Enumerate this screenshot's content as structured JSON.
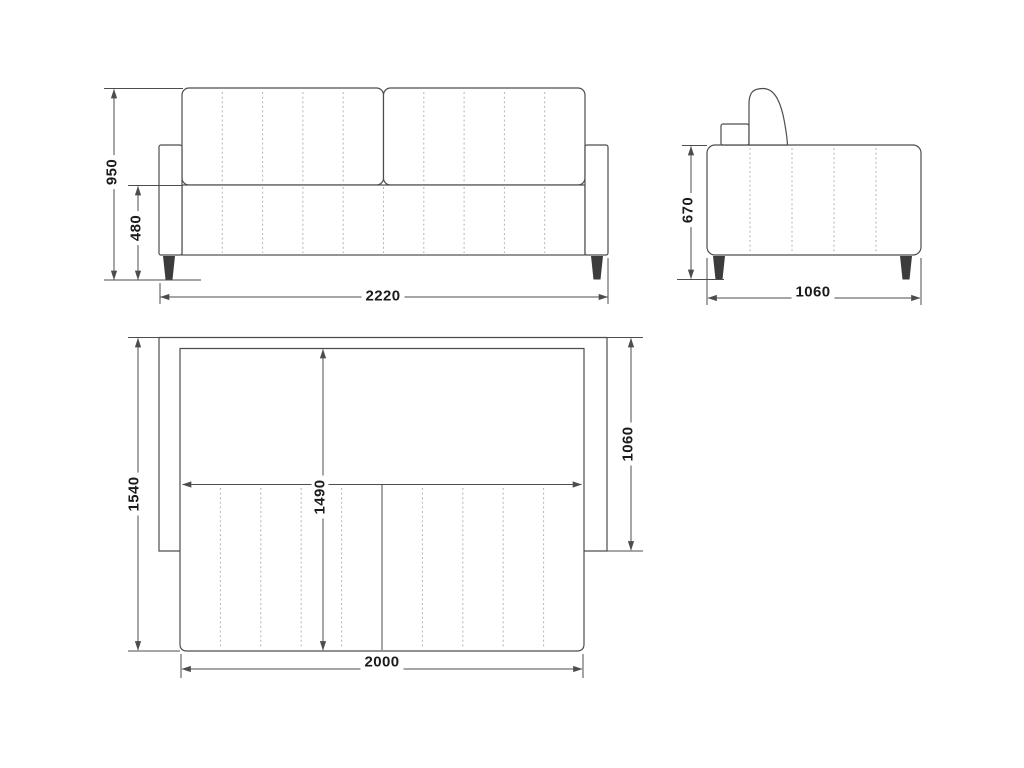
{
  "drawing": {
    "type": "sofa-bed-technical-drawing",
    "colors": {
      "background": "#ffffff",
      "outline": "#4d4d4d",
      "stitch": "#b5b5b5",
      "leg_fill": "#3c3c3c",
      "dimension_line": "#4d4d4d",
      "label_text": "#1b1b1b"
    },
    "views": {
      "front": {
        "dims": {
          "overall_height": "950",
          "seat_height": "480",
          "overall_width": "2220"
        }
      },
      "side": {
        "dims": {
          "armrest_height": "670",
          "overall_depth": "1060"
        }
      },
      "top": {
        "dims": {
          "unfolded_depth": "1540",
          "bed_length": "1490",
          "frame_depth": "1060",
          "bed_width": "2000"
        }
      }
    }
  }
}
